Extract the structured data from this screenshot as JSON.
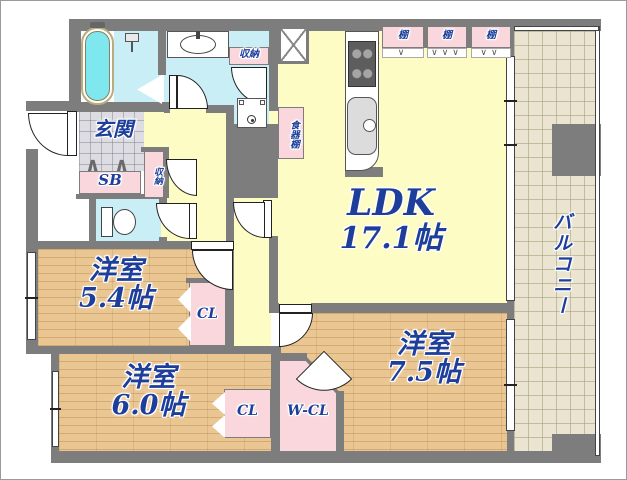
{
  "rooms": {
    "ldk": {
      "label": "LDK",
      "area": "17.1帖"
    },
    "bedroom1": {
      "label": "洋室",
      "area": "5.4帖"
    },
    "bedroom2": {
      "label": "洋室",
      "area": "6.0帖"
    },
    "bedroom3": {
      "label": "洋室",
      "area": "7.5帖"
    },
    "balcony": {
      "label": "バルコニー"
    },
    "entrance": {
      "label": "玄関"
    }
  },
  "storage": {
    "shoe_box": "SB",
    "closet_bedroom1": "CL",
    "closet_bedroom2": "CL",
    "walk_in_closet": "W-CL",
    "storage_washroom": "収納",
    "storage_entrance": "収納",
    "dish_cabinet": "食器棚",
    "shelf_1": "棚",
    "shelf_2": "棚",
    "shelf_3": "棚"
  },
  "symbols": {
    "fold_marks_shelf_1": "∨",
    "fold_marks_shelf_2": "∨∨∨",
    "fold_marks_shelf_3": "∨∨",
    "entrance_step_mark": "∧"
  },
  "colors": {
    "wall": "#7d7d7d",
    "room_yellow": "#fdfcc4",
    "wood_floor": "#eac692",
    "wet_area_cyan": "#c9eef6",
    "closet_pink": "#f9d7dc",
    "balcony_tile": "#eae4d0",
    "entrance_tile": "#dcdce2",
    "label_navy": "#1d3e9a"
  }
}
